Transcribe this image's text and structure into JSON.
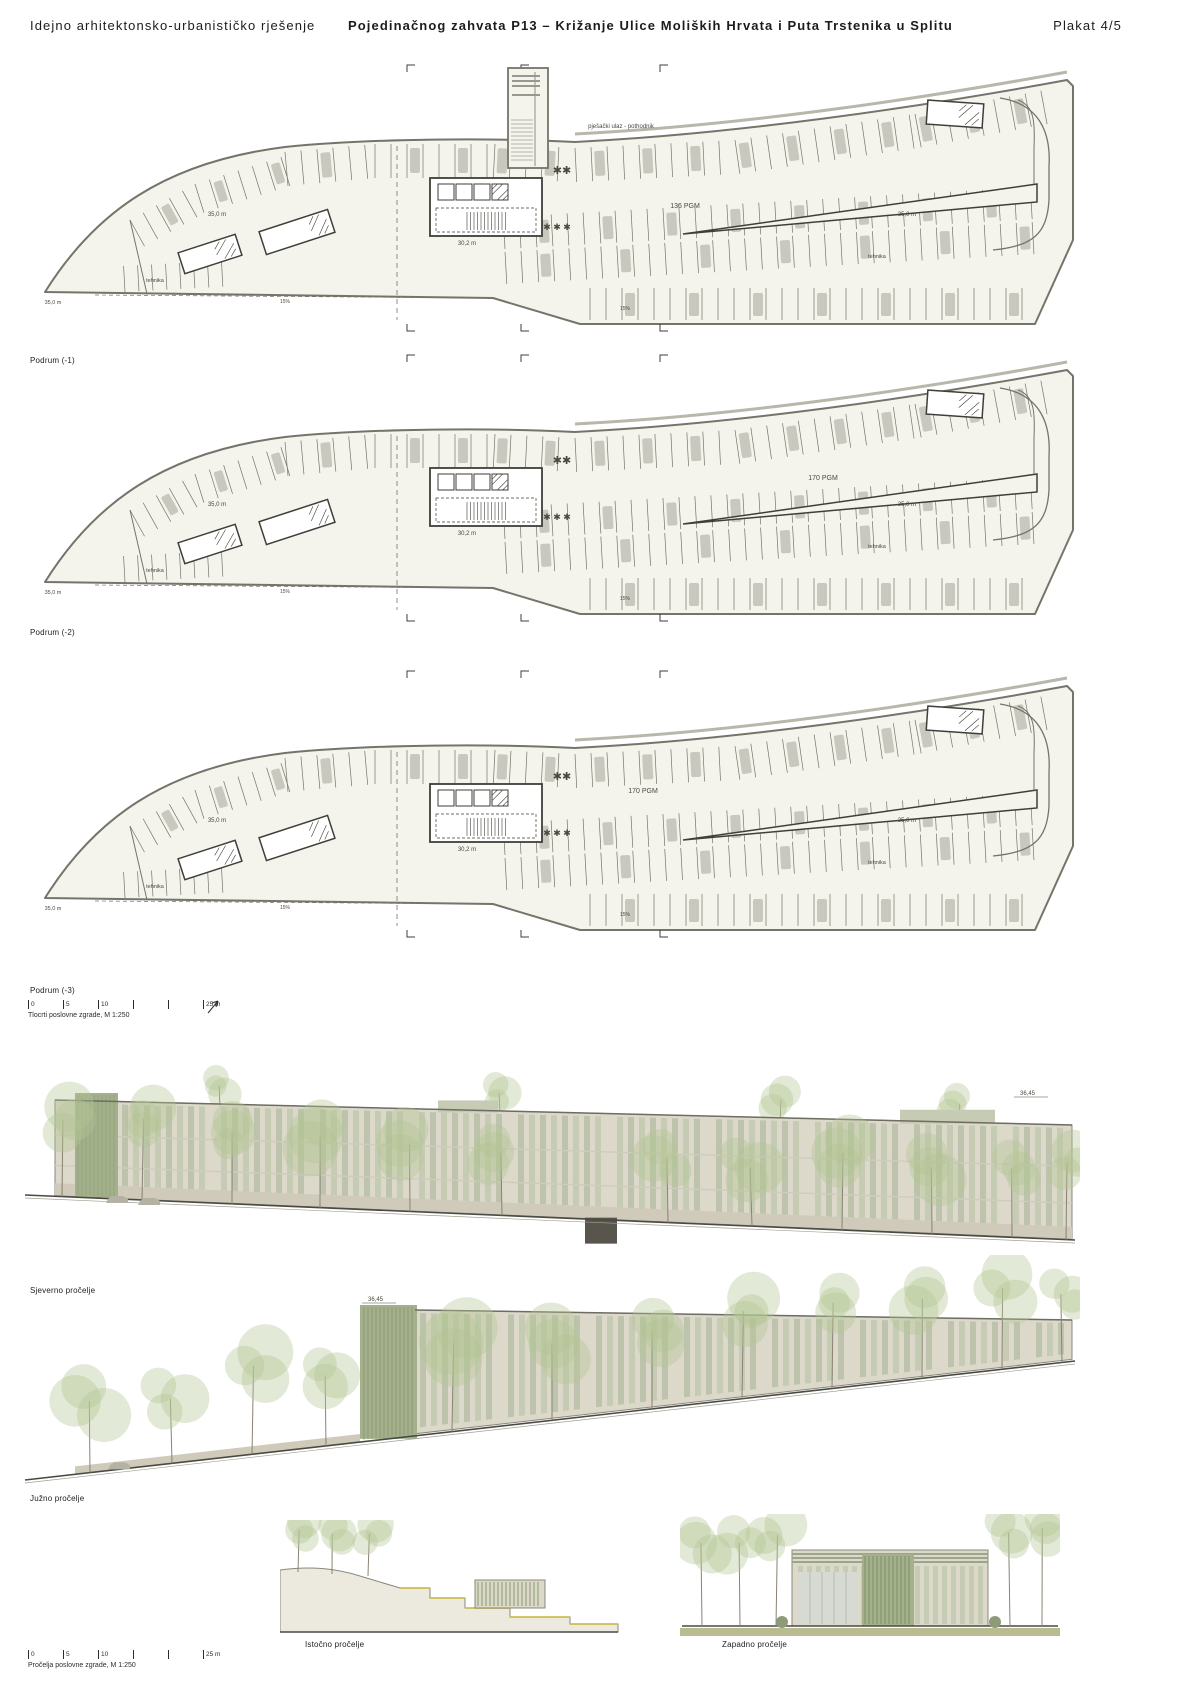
{
  "header": {
    "left_title": "Idejno arhitektonsko-urbanističko rješenje",
    "center_title": "Pojedinačnog zahvata P13 – Križanje Ulice Moliških Hrvata i Puta Trstenika u Splitu",
    "right_title": "Plakat 4/5"
  },
  "plans": {
    "items": [
      {
        "label": "Podrum (-1)",
        "capacity": "136 PGM"
      },
      {
        "label": "Podrum (-2)",
        "capacity": "170 PGM"
      },
      {
        "label": "Podrum (-3)",
        "capacity": "170 PGM"
      }
    ],
    "annotations": {
      "entrance": "pješački ulaz - pothodnik",
      "tech": "tehnika",
      "dim": "35,0 m",
      "dim2": "30,2 m",
      "slope": "15%",
      "vent": "✱✱",
      "vent2": "✱ ✱ ✱"
    },
    "scalebar": {
      "ticks": [
        "0",
        "5",
        "10",
        "25 m"
      ],
      "caption": "Tlocrti poslovne zgrade, M 1:250"
    }
  },
  "elevations": {
    "north_label": "Sjeverno pročelje",
    "south_label": "Južno pročelje",
    "east_label": "Istočno pročelje",
    "west_label": "Zapadno pročelje",
    "level_mark": "36,45",
    "scalebar": {
      "ticks": [
        "0",
        "5",
        "10",
        "25 m"
      ],
      "caption": "Pročelja poslovne zgrade, M 1:250"
    }
  },
  "colors": {
    "plan_fill": "#f4f3ec",
    "plan_line": "#76746a",
    "plan_dark": "#3f3e38",
    "stall_car": "#c9c8be",
    "road_band": "#b9b7ab",
    "facade_slat": "#c6cbb4",
    "facade_slat_alt": "#bdc3ac",
    "facade_slat_dark": "#a3b08b",
    "facade_base": "#dcd8ca",
    "facade_wall": "#cfcaba",
    "glass": "#d6dad3",
    "tree_foliage": "#b4c493",
    "tree_trunk": "#8a8274",
    "ground_line": "#4a4a42",
    "ground_strip": "#b9bc90",
    "accent_yellow": "#cdbd52",
    "entry_dark": "#57554c",
    "text_small": "#4a493f"
  }
}
